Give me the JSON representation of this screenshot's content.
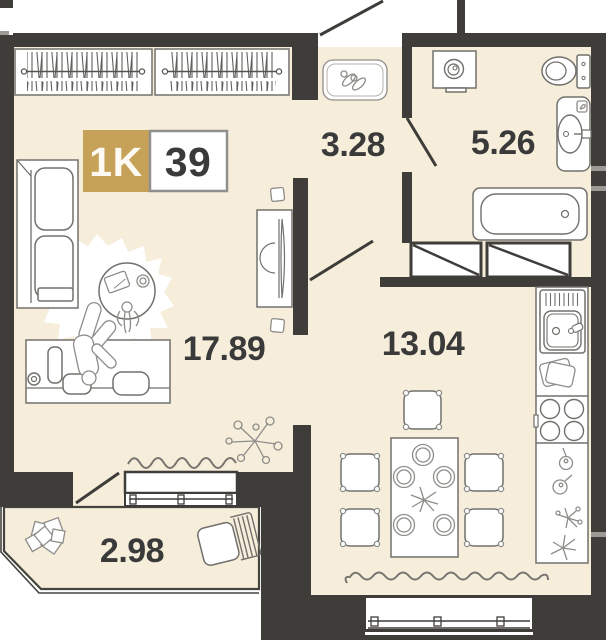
{
  "badge": {
    "type": "1K",
    "total_area": "39"
  },
  "rooms": {
    "hallway": {
      "area": "3.28"
    },
    "bathroom": {
      "area": "5.26"
    },
    "living_room": {
      "area": "17.89"
    },
    "kitchen": {
      "area": "13.04"
    },
    "balcony": {
      "area": "2.98"
    }
  },
  "colors": {
    "accent_gold": "#c6a258",
    "wall": "#3e3d3a",
    "floor": "#f6eedb",
    "label_text": "#3a3a3a"
  }
}
